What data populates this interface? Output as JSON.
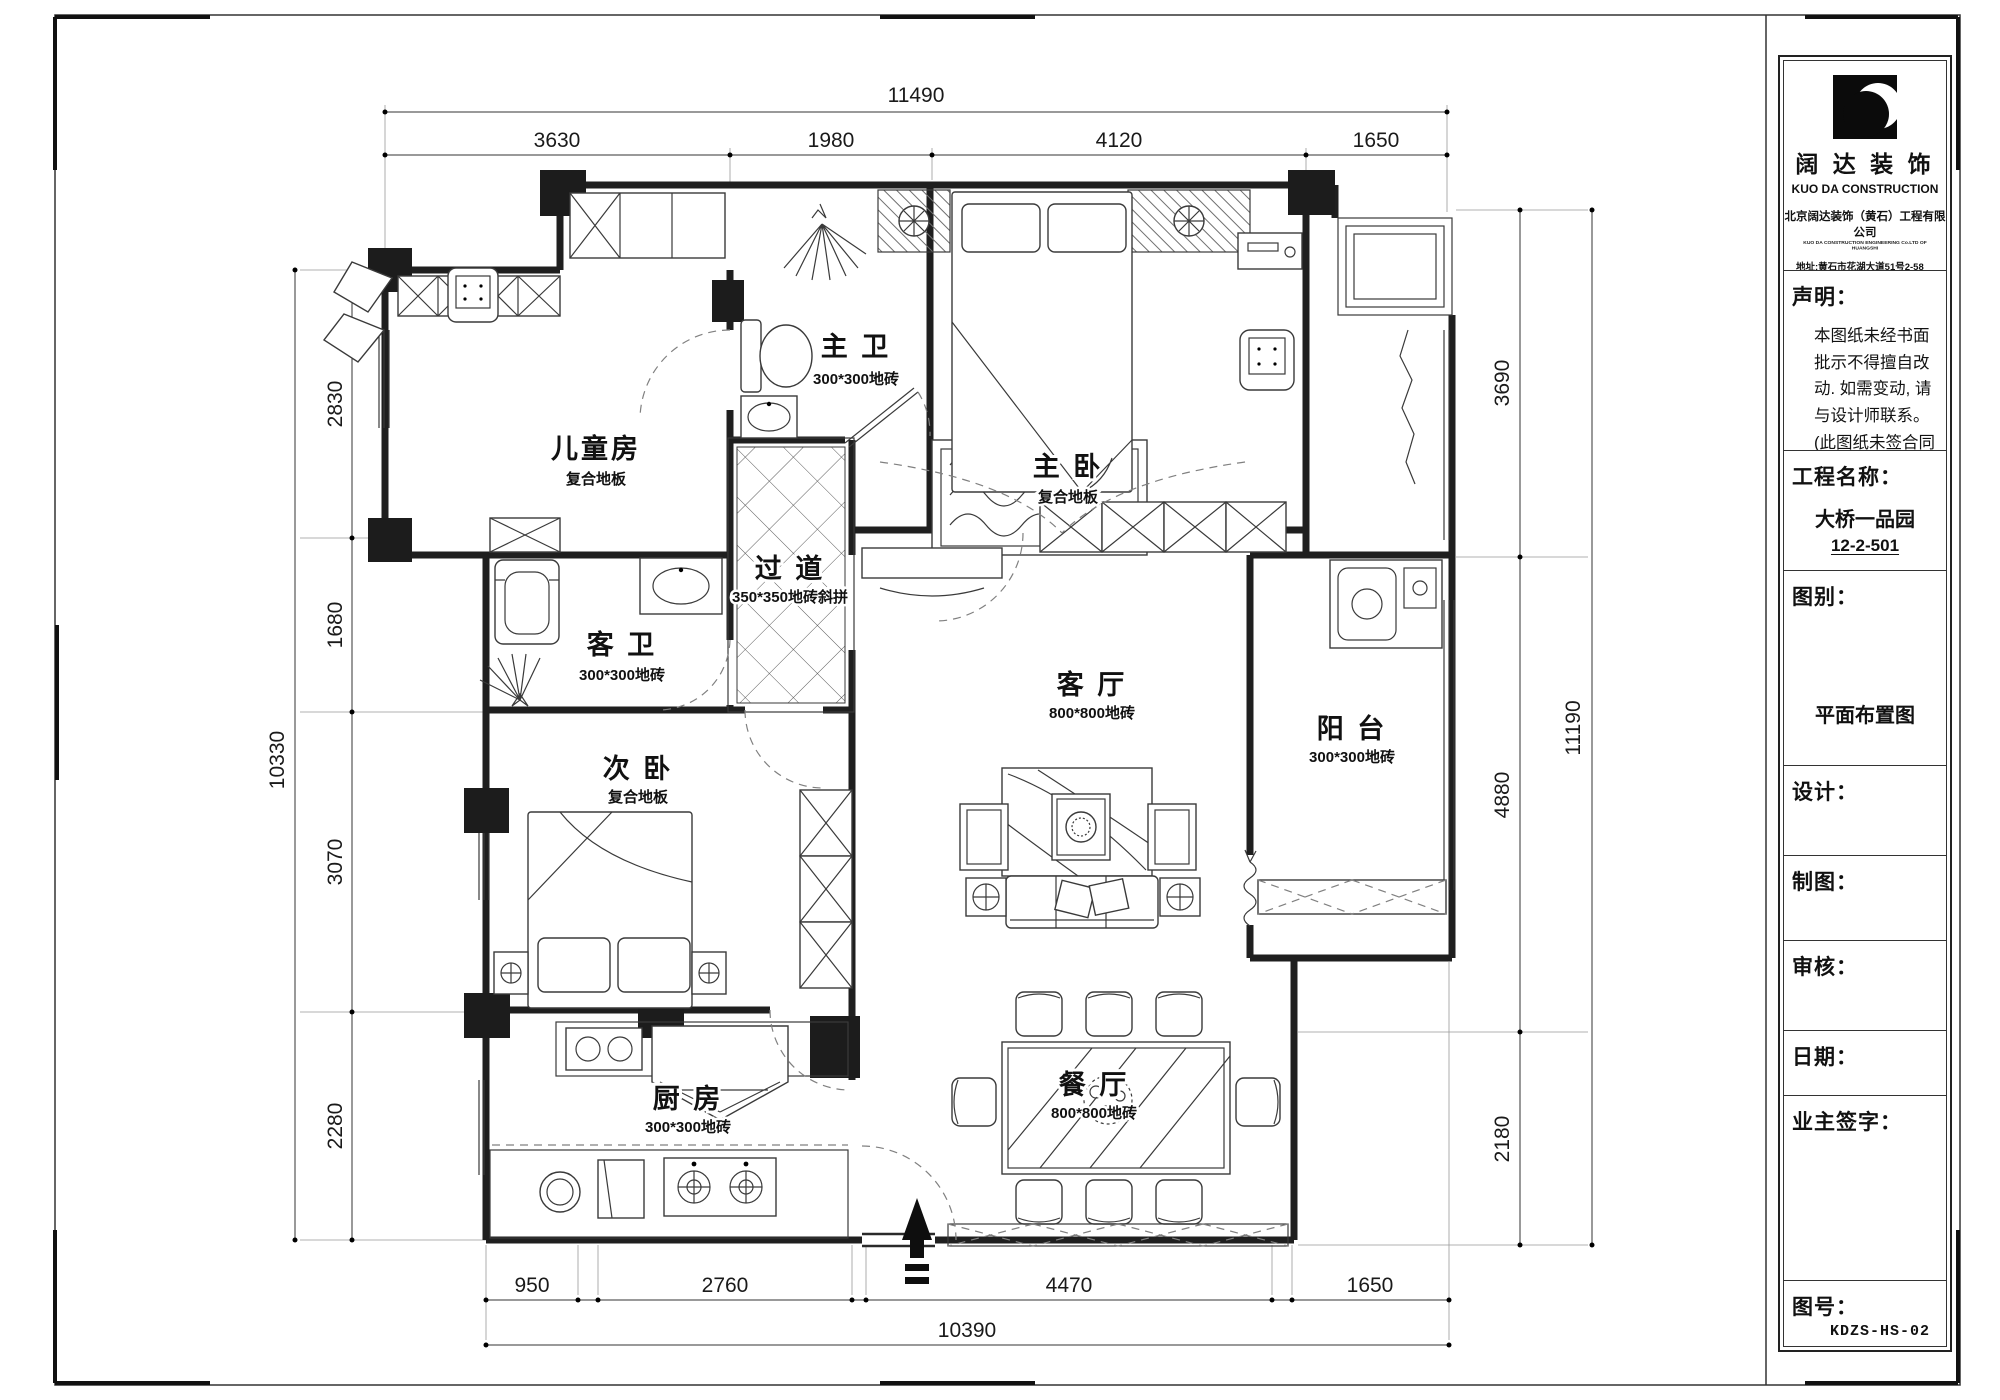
{
  "colors": {
    "ink": "#1f1f1f",
    "paper": "#ffffff"
  },
  "dimensions": {
    "top": {
      "total": "11490",
      "segments": [
        "3630",
        "1980",
        "4120",
        "1650"
      ]
    },
    "bottom": {
      "total": "10390",
      "segments": [
        "950",
        "2760",
        "4470",
        "1650"
      ]
    },
    "left": {
      "total": "10330",
      "segments": [
        "2830",
        "1680",
        "3070",
        "2280"
      ]
    },
    "right": {
      "total": "11190",
      "segments": [
        "3690",
        "4880",
        "2180"
      ]
    }
  },
  "rooms": [
    {
      "name": "儿童房",
      "floor": "复合地板"
    },
    {
      "name": "主 卫",
      "floor": "300*300地砖"
    },
    {
      "name": "主 卧",
      "floor": "复合地板"
    },
    {
      "name": "过 道",
      "floor": "350*350地砖斜拼"
    },
    {
      "name": "客 卫",
      "floor": "300*300地砖"
    },
    {
      "name": "次 卧",
      "floor": "复合地板"
    },
    {
      "name": "客 厅",
      "floor": "800*800地砖"
    },
    {
      "name": "阳 台",
      "floor": "300*300地砖"
    },
    {
      "name": "厨 房",
      "floor": "300*300地砖"
    },
    {
      "name": "餐 厅",
      "floor": "800*800地砖"
    }
  ],
  "title_block": {
    "logo": {
      "brand_cn": "阔 达 装 饰",
      "brand_en": "KUO DA CONSTRUCTION",
      "company": "北京阔达装饰（黄石）工程有限公司",
      "company_en": "KUO DA CONSTRUCTION ENGINEERING Co.LTD OF HUANGSHI",
      "address": "地址:黄石市花湖大道51号2-58",
      "phone": "电话:0714-6576666"
    },
    "statement": {
      "label": "声明：",
      "lines": [
        "本图纸未经书面",
        "批示不得擅自改",
        "动. 如需变动, 请",
        "与设计师联系。",
        "(此图纸未签合同",
        "之前，勿赠客户.)"
      ]
    },
    "project": {
      "label": "工程名称：",
      "name": "大桥一品园",
      "unit": "12-2-501"
    },
    "drawing_type": {
      "label": "图别：",
      "value": "平面布置图"
    },
    "fields": [
      {
        "label": "设计："
      },
      {
        "label": "制图："
      },
      {
        "label": "审核："
      },
      {
        "label": "日期："
      },
      {
        "label": "业主签字："
      }
    ],
    "drawing_no": {
      "label": "图号：",
      "value": "KDZS-HS-02"
    }
  }
}
